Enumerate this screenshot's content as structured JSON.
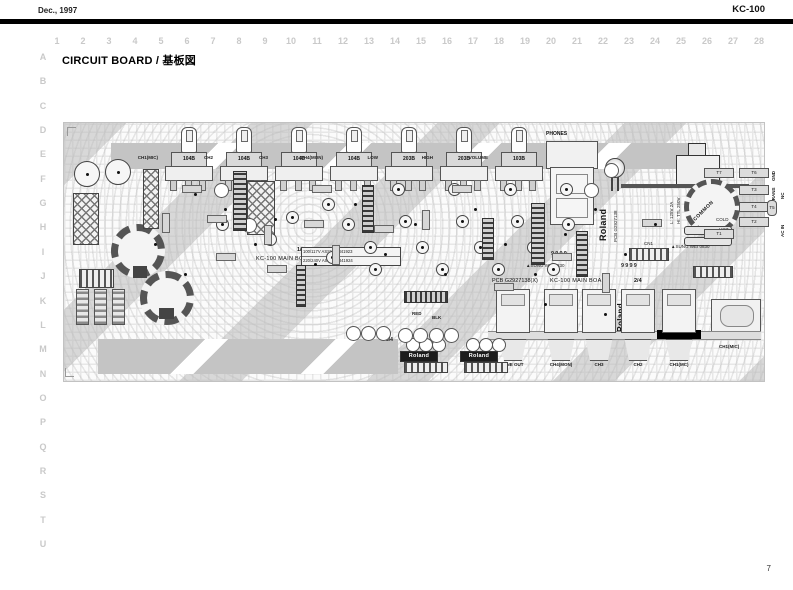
{
  "page": {
    "date": "Dec., 1997",
    "model": "KC-100",
    "title": "CIRCUIT BOARD / 基板図",
    "page_number": "7",
    "grid_columns": [
      "1",
      "2",
      "3",
      "4",
      "5",
      "6",
      "7",
      "8",
      "9",
      "10",
      "11",
      "12",
      "13",
      "14",
      "15",
      "16",
      "17",
      "18",
      "19",
      "20",
      "21",
      "22",
      "23",
      "24",
      "25",
      "26",
      "27",
      "28"
    ],
    "grid_rows": [
      "A",
      "B",
      "C",
      "D",
      "E",
      "F",
      "G",
      "H",
      "I",
      "J",
      "K",
      "L",
      "M",
      "N",
      "O",
      "P",
      "Q",
      "R",
      "S",
      "T",
      "U"
    ]
  },
  "board": {
    "pots": [
      {
        "channel": "CH1(MIC)",
        "value": "104B"
      },
      {
        "channel": "CH2",
        "value": "104B"
      },
      {
        "channel": "CH3",
        "value": "104B"
      },
      {
        "channel": "CH4(MON)",
        "value": "104B"
      },
      {
        "channel": "LOW",
        "value": "203B"
      },
      {
        "channel": "HIGH",
        "value": "203B"
      },
      {
        "channel": "VOLUME",
        "value": "103B"
      }
    ],
    "phones": "PHONES",
    "main_board_1": {
      "fraction": "1/4",
      "name": "KC-100 MAIN BOARD",
      "assy_rows": [
        "100/117V ASSY 01341923",
        "220/240V ASSY 01341924"
      ]
    },
    "main_board_2": {
      "pcb": "PCB G2927138(X)",
      "name": "KC-100 MAIN BOARD",
      "fraction": "2/4"
    },
    "roland_logo": "Roland",
    "pcb_number": "PCB G2927138",
    "fuse": {
      "line1": "L: 125V 2A",
      "line2": "HI: TTL 250V"
    },
    "terminals": {
      "pads": [
        "T1",
        "T2",
        "T3",
        "T4",
        "T5",
        "T6",
        "T7"
      ],
      "gnd": "GND",
      "trans": "TRANS",
      "nc": "NC",
      "ac_in": "AC IN",
      "cold": "COLD",
      "hot": "HOT",
      "common": "COMMON"
    },
    "connector": "CN1",
    "jacks": [
      "LINE OUT",
      "CH4(MON)",
      "CH3",
      "CH2",
      "CH1(MC)"
    ],
    "st_marking": "ST",
    "xlr_jack": "CH1(MIC)",
    "sub_boards": [
      {
        "fraction": "3/4"
      },
      {
        "fraction": "4/4"
      }
    ],
    "date_stamps": [
      "9999",
      "9999"
    ],
    "vendor_stamp": "▲SUNG WEI 0830",
    "wire_labels": {
      "red": "RED",
      "blk": "BLK"
    }
  }
}
